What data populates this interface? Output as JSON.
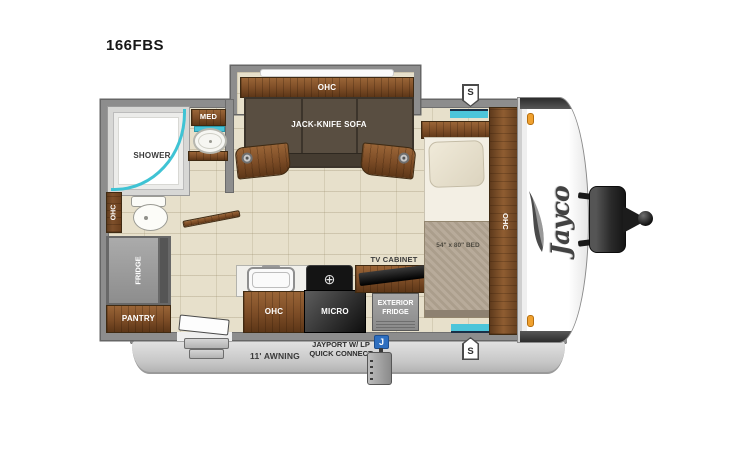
{
  "model": "166FBS",
  "brand_logo": "Jayco",
  "badges": {
    "speaker": "S",
    "jayport": "J"
  },
  "rooms": {
    "bathroom": {
      "shower": "SHOWER",
      "med_cabinet": "MED",
      "overhead_cabinet": "OHC"
    },
    "living": {
      "overhead_cabinet": "OHC",
      "sofa": "JACK-KNIFE SOFA"
    },
    "kitchen": {
      "overhead_cabinet": "OHC",
      "microwave": "MICRO",
      "tv_cabinet": "TV CABINET",
      "exterior_fridge": "EXTERIOR FRIDGE"
    },
    "storage": {
      "fridge": "FRIDGE",
      "pantry": "PANTRY"
    },
    "bedroom": {
      "bed": "54\" x 80\" BED",
      "overhead_cabinet": "OHC"
    },
    "exterior": {
      "awning": "11' AWNING",
      "jayport": "JAYPORT W/ LP QUICK CONNECT"
    }
  },
  "colors": {
    "wall_gray": "#8d8d8d",
    "floor_beige": "#e7e0cb",
    "wood_brown": "#7c4c26",
    "accent_teal": "#47c3d8",
    "jayport_blue": "#2e6fc0",
    "marker_orange": "#f0a12f"
  }
}
